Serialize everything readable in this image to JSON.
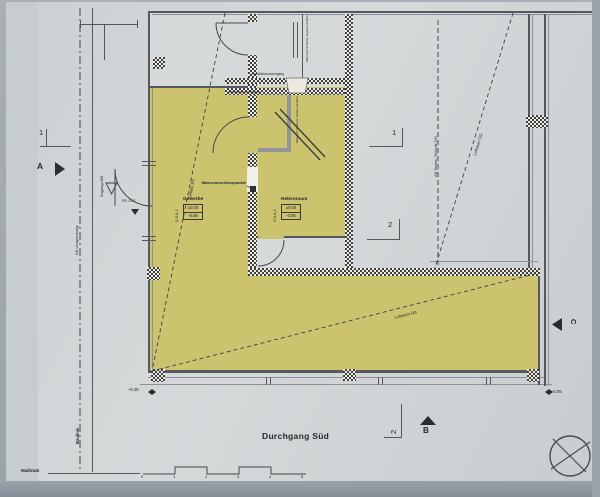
{
  "markers": {
    "a": "A",
    "b": "B",
    "c": "C",
    "sec1_left": "1",
    "sec1_right": "1",
    "sec2_right": "2",
    "sec2_bottom": "2"
  },
  "rooms": {
    "gewerbe": {
      "code": "G.0.6-1",
      "name": "Gewerbe",
      "level_top": "±0.00",
      "level_bottom": "-0.56"
    },
    "nebenraum": {
      "code": "G.0.6-2",
      "name": "Nebenraum",
      "level_top": "±0.00",
      "level_bottom": "-0.56"
    }
  },
  "annotations": {
    "wasseranschluss": "Wasseranschlusspunkte",
    "installation_top": "Installationsdurchgang",
    "installation_bottom": "Installationsdurchgang",
    "wand_schuerze_top": "Wand als Schürze, Kanten sichtbar",
    "wand_schuerze_room": "Wand als Schürze, Kanten sichtbar",
    "zugang": "Zugang 006",
    "fb_level": "FB -0.02",
    "ak_umgrenzung": "AK Umgrenzung",
    "baulinie": "Baulinie",
    "ak_decke": "AK Decke, Technik OG",
    "luftraum_diag_right": "Luftraum OG",
    "luftraum_diag_bottom": "Luftraum OG",
    "gefaelle": "Gefälle 3%",
    "spot_left": "+0.38",
    "spot_right": "-0.05",
    "footer_label": "Maßstab"
  },
  "titles": {
    "durchgang_sued": "Durchgang Süd"
  },
  "scale_bar": {
    "ticks": [
      "0",
      "1",
      "2",
      "3",
      "4",
      "5"
    ]
  },
  "colors": {
    "highlight": "#ccc36e",
    "sheet": "#d0d4d6",
    "wall": "#3e4044",
    "line": "#55585c"
  }
}
